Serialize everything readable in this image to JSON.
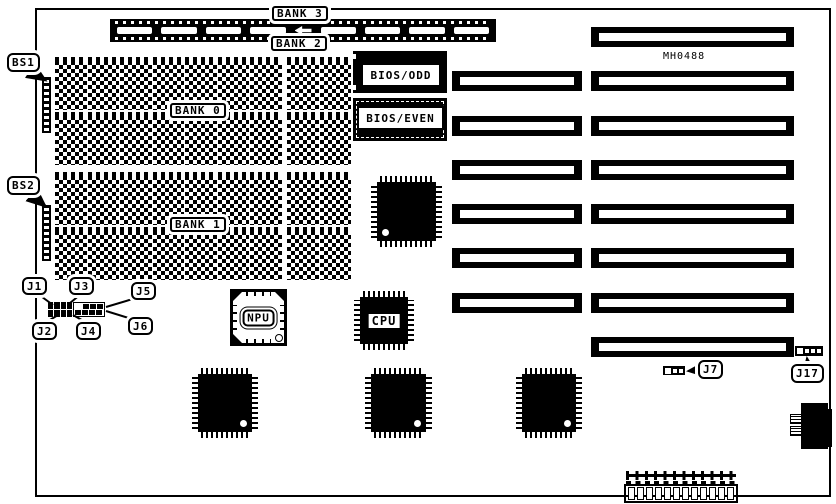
{
  "board": {
    "part_number": "MH0488",
    "memory": {
      "bank0_label": "BANK 0",
      "bank1_label": "BANK 1",
      "bank2_label": "BANK 2",
      "bank3_label": "BANK 3",
      "dram_rows": 4,
      "dram_chips_main_group": 7,
      "dram_chips_side_group": 2,
      "simm_slot_count": 8
    },
    "chips": {
      "bios_odd_label": "BIOS/ODD",
      "bios_even_label": "BIOS/EVEN",
      "npu_label": "NPU",
      "cpu_label": "CPU"
    },
    "connectors": {
      "bs1_label": "BS1",
      "bs2_label": "BS2",
      "j1_label": "J1",
      "j2_label": "J2",
      "j3_label": "J3",
      "j4_label": "J4",
      "j5_label": "J5",
      "j6_label": "J6",
      "j7_label": "J7",
      "j17_label": "J17",
      "j7_pin_count": 3,
      "j17_pin_count": 4,
      "power_pin_count": 12
    },
    "expansion_slots": {
      "left_column_count": 6,
      "right_column_count": 8
    },
    "colors": {
      "ink": "#000000",
      "paper": "#ffffff"
    }
  }
}
